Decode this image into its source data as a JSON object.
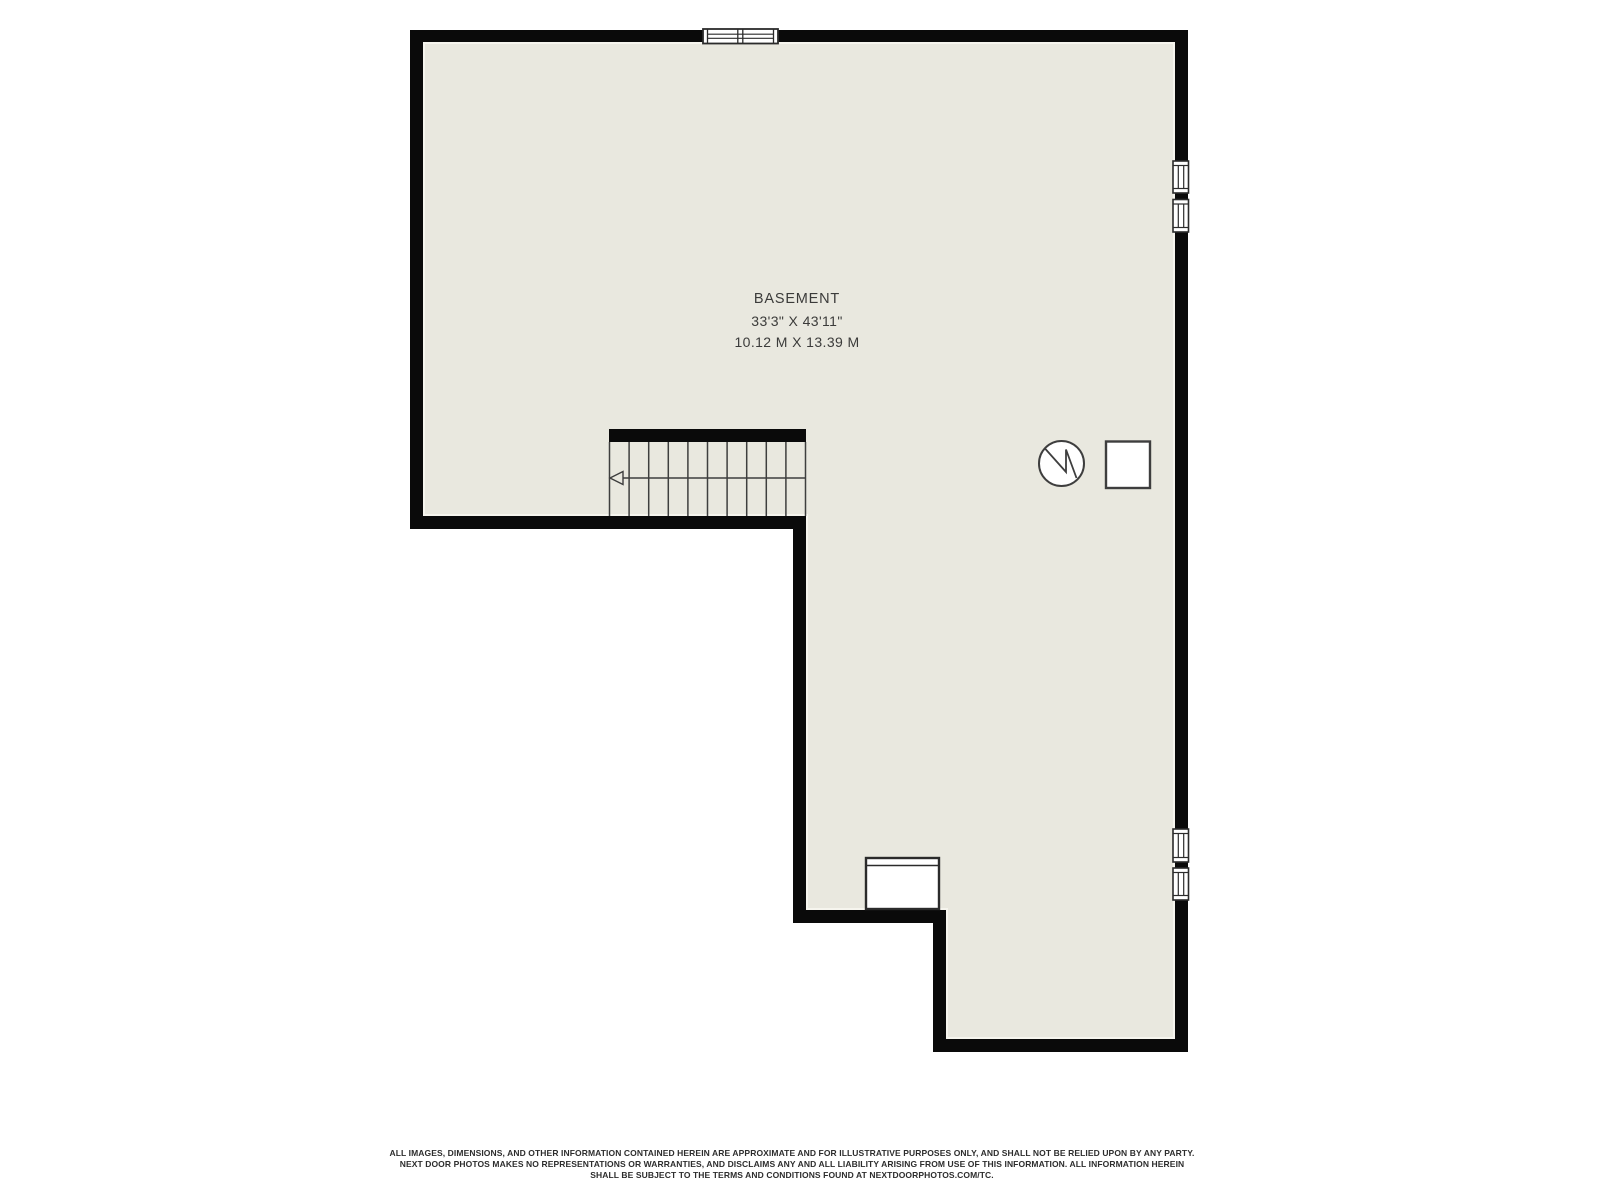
{
  "room": {
    "name": "BASEMENT",
    "dimensions_imperial": "33'3\" X 43'11\"",
    "dimensions_metric": "10.12 M X 13.39 M"
  },
  "disclaimer": {
    "lines": [
      "ALL IMAGES, DIMENSIONS, AND OTHER INFORMATION CONTAINED HEREIN ARE APPROXIMATE AND FOR ILLUSTRATIVE PURPOSES ONLY, AND SHALL NOT BE RELIED UPON BY ANY PARTY.",
      "NEXT DOOR PHOTOS MAKES NO REPRESENTATIONS OR WARRANTIES, AND DISCLAIMS ANY AND ALL LIABILITY ARISING FROM USE OF THIS INFORMATION. ALL INFORMATION HEREIN",
      "SHALL BE SUBJECT TO THE TERMS AND CONDITIONS FOUND AT NEXTDOORPHOTOS.COM/TC."
    ]
  },
  "floorplan": {
    "features": {
      "staircase": {
        "treads": 10,
        "direction_arrow": "left"
      },
      "water_heater_icon": "circle-with-zigzag",
      "furnace_icon": "square-outline",
      "window_well_fixture": "rectangle-on-bottom-wall",
      "windows": {
        "top_wall": 1,
        "right_wall_upper": 2,
        "right_wall_lower": 2
      }
    },
    "colors": {
      "background": "#FFFFFF",
      "floor": "#E9E8DF",
      "walls": "#0A0A0A",
      "lines": "#3E3E3E",
      "label_text": "#3B3B3B"
    }
  }
}
